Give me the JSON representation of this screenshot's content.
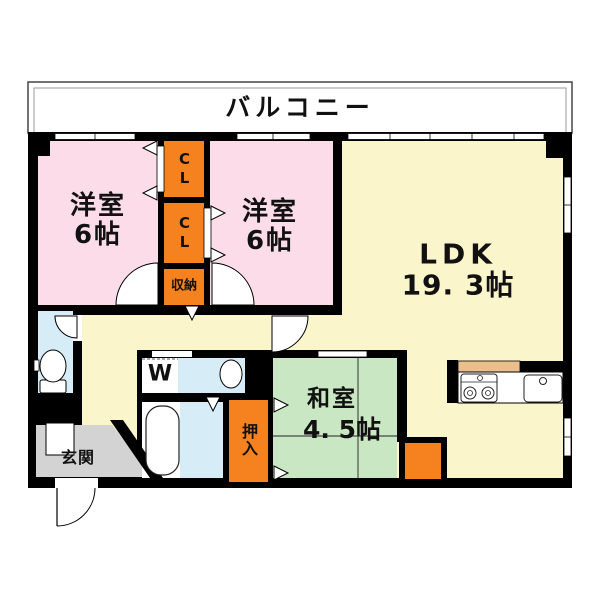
{
  "colors": {
    "wall": "#000000",
    "bedroom": "#FBDCE8",
    "ldk": "#FBF5CB",
    "tatami": "#C9E7C2",
    "storage": "#F5821E",
    "sanitary": "#D6EDF8",
    "entrance": "#D3D3D3",
    "counter": "#EBBE8B",
    "white": "#FFFFFF"
  },
  "floorplan": {
    "balcony": {
      "label": "バルコニー"
    },
    "bedroom1": {
      "label": "洋室",
      "size": "6帖"
    },
    "bedroom2": {
      "label": "洋室",
      "size": "6帖"
    },
    "ldk": {
      "label": "LDK",
      "size": "19. 3帖"
    },
    "japanese_room": {
      "label": "和室",
      "size": "4. 5帖"
    },
    "closet1": {
      "label": "CL"
    },
    "closet2": {
      "label": "CL"
    },
    "storage": {
      "label": "収納"
    },
    "oshiire": {
      "label": "押入"
    },
    "entrance": {
      "label": "玄関"
    },
    "laundry": {
      "label": "W"
    }
  }
}
